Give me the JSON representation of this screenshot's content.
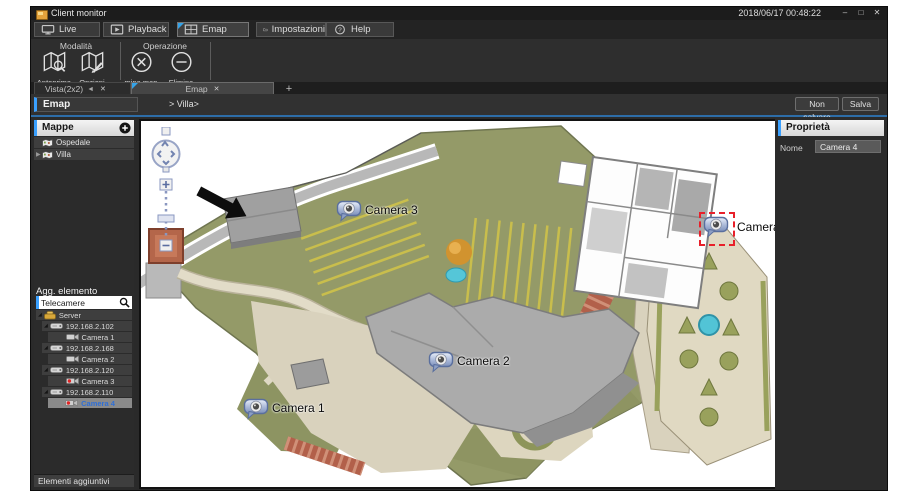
{
  "window": {
    "title": "Client monitor",
    "clock": "2018/06/17 00:48:22"
  },
  "main_tabs": [
    {
      "label": "Live",
      "icon": "monitor-icon",
      "active": false
    },
    {
      "label": "Playback",
      "icon": "playback-icon",
      "active": false
    },
    {
      "label": "Emap",
      "icon": "emap-icon",
      "active": true
    },
    {
      "label": "Impostazioni",
      "icon": "settings-icon",
      "active": false
    },
    {
      "label": "Help",
      "icon": "help-icon",
      "active": false
    }
  ],
  "ribbon": {
    "groups": [
      {
        "title": "Modalità",
        "buttons": [
          {
            "label": "Anteprima",
            "icon": "map-preview-icon"
          },
          {
            "label": "Opzioni",
            "icon": "map-edit-icon"
          }
        ]
      },
      {
        "title": "Operazione",
        "buttons": [
          {
            "label": "Elimina mappa",
            "icon": "delete-map-icon"
          },
          {
            "label": "Elimina",
            "icon": "delete-icon"
          }
        ]
      }
    ]
  },
  "subtabs": {
    "view_tab": "Vista(2x2)",
    "emap_tab": "Emap"
  },
  "emap_header": {
    "title": "Emap",
    "breadcrumb": "> Villa>",
    "discard_button": "Non salvare",
    "save_button": "Salva"
  },
  "sidebar": {
    "maps_header": "Mappe",
    "maps": [
      {
        "label": "Ospedale"
      },
      {
        "label": "Villa"
      }
    ],
    "add_element_title": "Agg. elemento",
    "search_value": "Telecamere",
    "tree": [
      {
        "label": "Server",
        "level": 0,
        "icon": "server-icon"
      },
      {
        "label": "192.168.2.102",
        "level": 1,
        "icon": "device-icon"
      },
      {
        "label": "Camera 1",
        "level": 2,
        "icon": "camera-icon"
      },
      {
        "label": "192.168.2.168",
        "level": 1,
        "icon": "device-icon"
      },
      {
        "label": "Camera 2",
        "level": 2,
        "icon": "camera-icon"
      },
      {
        "label": "192.168.2.120",
        "level": 1,
        "icon": "device-icon"
      },
      {
        "label": "Camera 3",
        "level": 2,
        "icon": "camera-recording-icon"
      },
      {
        "label": "192.168.2.110",
        "level": 1,
        "icon": "device-icon"
      },
      {
        "label": "Camera 4",
        "level": 2,
        "icon": "camera-recording-icon",
        "selected": true
      }
    ],
    "footer": "Elementi aggiuntivi"
  },
  "properties": {
    "title": "Proprietà",
    "name_label": "Nome",
    "name_value": "Camera 4"
  },
  "map": {
    "markers": [
      {
        "label": "Camera 3",
        "selected": false
      },
      {
        "label": "Camera 4",
        "selected": true
      },
      {
        "label": "Camera 2",
        "selected": false
      },
      {
        "label": "Camera 1",
        "selected": false
      }
    ]
  },
  "colors": {
    "accent_blue": "#3aa0ff",
    "header_underline": "#2d6da8",
    "selection_red": "#e8202a",
    "selected_text_blue": "#2f6fd6"
  }
}
